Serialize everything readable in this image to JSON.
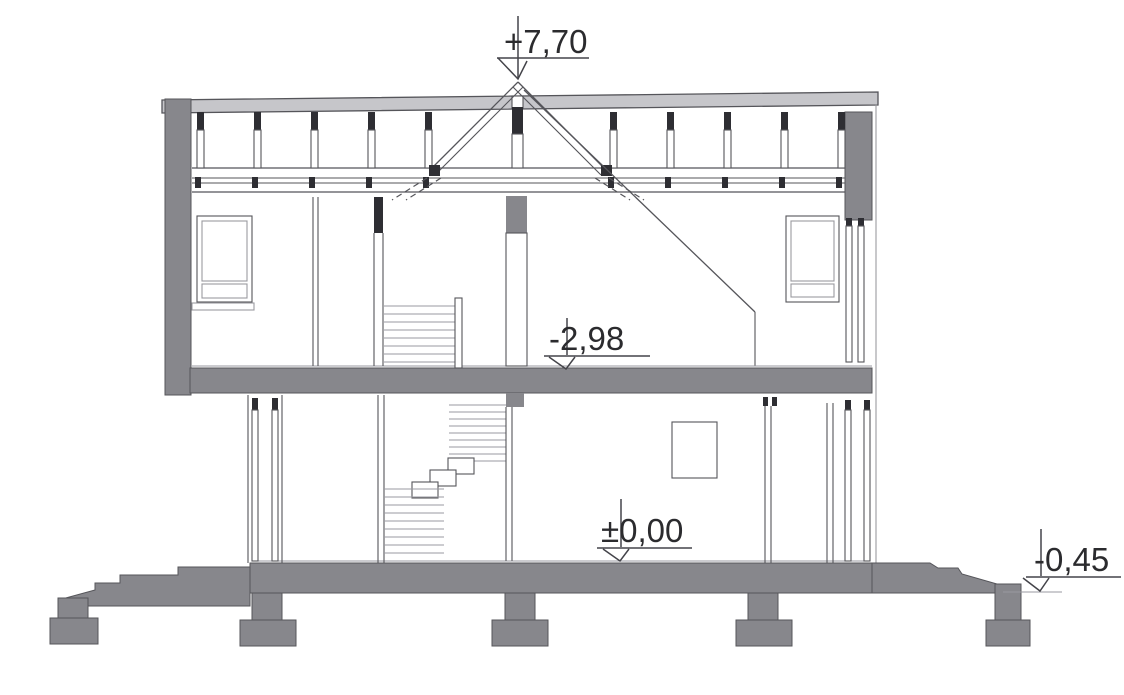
{
  "drawing": {
    "kind": "house-cross-section",
    "levels": {
      "ridge": {
        "label": "+7,70"
      },
      "attic_floor": {
        "label": "-2,98"
      },
      "ground_floor": {
        "label": "±0,00"
      },
      "terrain": {
        "label": "-0,45"
      }
    },
    "colors": {
      "wall_fill": "#87878c",
      "roof_fill": "#c6c6ca",
      "dark_fill": "#2e2e33",
      "line": "#55555a",
      "light_line": "#9a9aa0",
      "text": "#2b2b2e",
      "background": "#ffffff"
    }
  }
}
